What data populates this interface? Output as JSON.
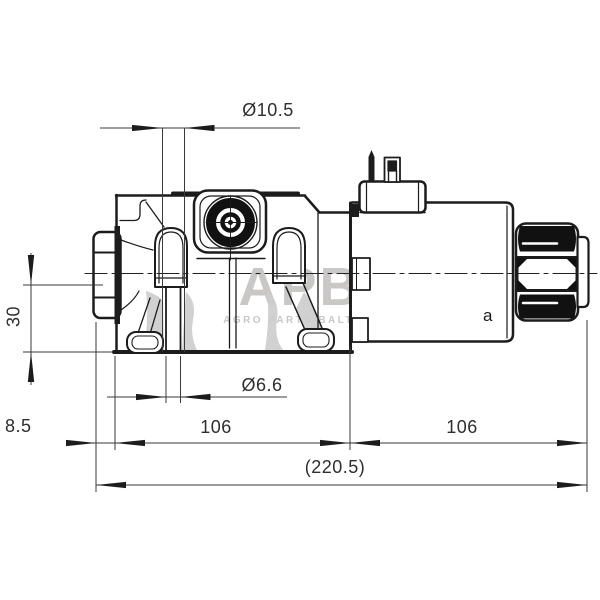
{
  "drawing": {
    "type": "technical-drawing",
    "subject": "hydraulic solenoid directional valve, side section view",
    "dimensions": {
      "counterbore_diameter": "Ø10.5",
      "through_hole_diameter": "Ø6.6",
      "axis_height": "30",
      "left_offset": "8.5",
      "body_length": "106",
      "solenoid_length": "106",
      "overall_length": "(220.5)"
    },
    "labels": {
      "solenoid_side": "a"
    },
    "watermark": {
      "logo": "APB",
      "subtitle": "AGRO PARTS BALTIJA"
    },
    "colors": {
      "line": "#1c1c1c",
      "dimension_line": "#3a3a3a",
      "section_fill": "#cdcdcd",
      "watermark": "#c9c8c6",
      "background": "#ffffff"
    }
  }
}
